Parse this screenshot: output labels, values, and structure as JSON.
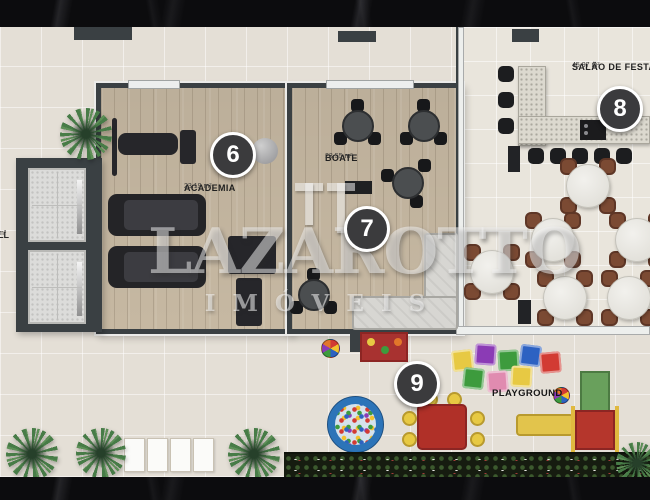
{
  "theme": {
    "terrace": "#e4dfd6",
    "wood": "#c6b8a2",
    "salao_floor": "#e9e5dc",
    "wall_dark": "#3a4043",
    "marker_bg": "#3b3b3d",
    "chair_brown": "#7b4a33",
    "counter": "#dcd9cf",
    "sofa": "#d7d6d2",
    "pg_red": "#c87b6d",
    "pg_teal": "#83bac0",
    "pg_cream": "#ecddae",
    "ballpit_blue": "#2c74b8",
    "kids_red": "#b03028",
    "kids_yellow": "#e7c943",
    "slide_green": "#69a05c",
    "bench_yellow": "#e2c44c",
    "hedge": "#161c10"
  },
  "watermark": {
    "logo": "TT",
    "brand": "LAZAROTTO",
    "subtitle": "IMÓVEIS"
  },
  "rooms": {
    "academia": {
      "number": "6",
      "name": "ACADEMIA",
      "area": "23.19 m²"
    },
    "boate": {
      "number": "7",
      "name": "BOATE",
      "area": "23.55 m²"
    },
    "salao": {
      "number": "8",
      "name": "SALÃO DE FESTA",
      "area": "45.97 m²"
    },
    "playground": {
      "number": "9",
      "name": "PLAYGROUND"
    }
  },
  "hall_partial": {
    "line1": "LL",
    "line2": "m²"
  }
}
